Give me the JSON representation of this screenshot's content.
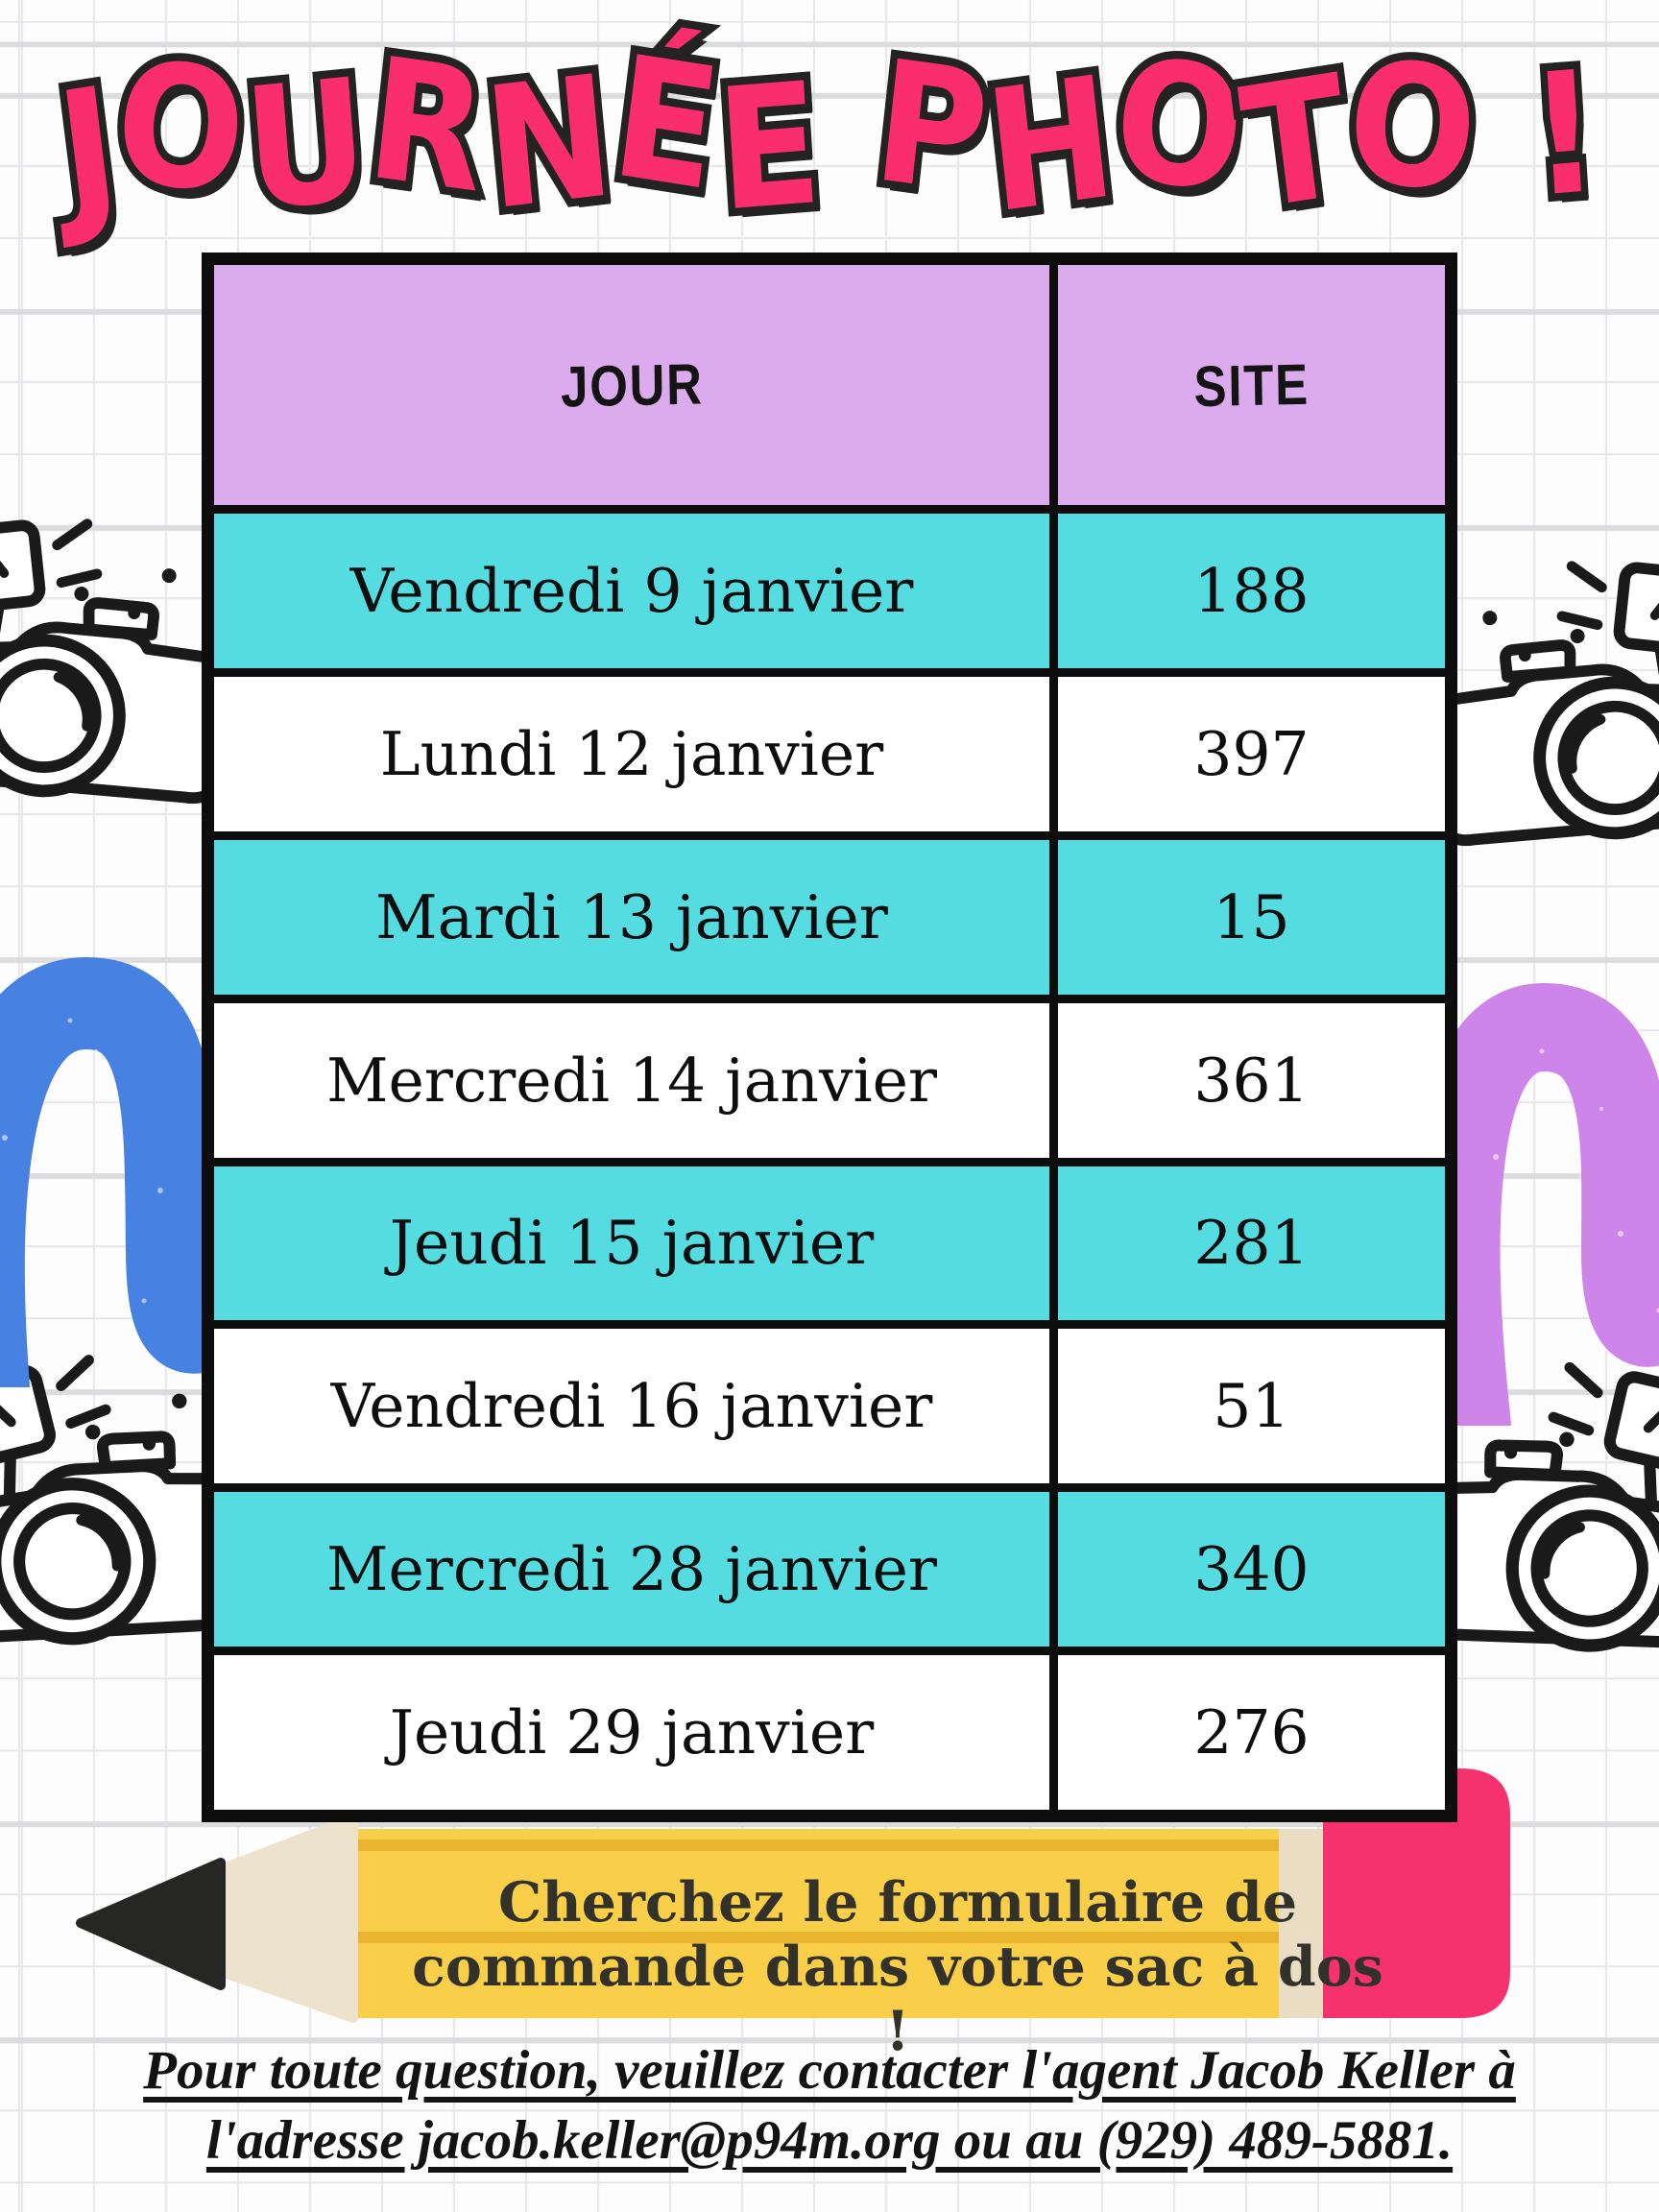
{
  "poster": {
    "title": "JOURNÉE PHOTO !",
    "table": {
      "headers": {
        "jour": "JOUR",
        "site": "SITE"
      },
      "rows": [
        {
          "jour": "Vendredi 9 janvier",
          "site": "188"
        },
        {
          "jour": "Lundi 12 janvier",
          "site": "397"
        },
        {
          "jour": "Mardi 13 janvier",
          "site": "15"
        },
        {
          "jour": "Mercredi 14 janvier",
          "site": "361"
        },
        {
          "jour": "Jeudi 15 janvier",
          "site": "281"
        },
        {
          "jour": "Vendredi 16 janvier",
          "site": "51"
        },
        {
          "jour": "Mercredi 28 janvier",
          "site": "340"
        },
        {
          "jour": "Jeudi 29 janvier",
          "site": "276"
        }
      ]
    },
    "pencil_note": {
      "line1": "Cherchez le formulaire de",
      "line2": "commande dans votre sac à dos !"
    },
    "footer": {
      "line1": "Pour toute question, veuillez contacter l'agent Jacob Keller à",
      "line2": "l'adresse jacob.keller@p94m.org ou au (929) 489-5881."
    },
    "colors": {
      "title_pink": "#fa2e6f",
      "outline_black": "#232323",
      "header_purple": "#dcabee",
      "row_cyan": "#55dce1",
      "pencil_yellow": "#f9ce49",
      "pencil_ridge": "#e9b52f",
      "pencil_wood": "#ede3cd",
      "eraser_pink": "#f5316e",
      "squiggle_blue": "#4781e1",
      "squiggle_purple": "#cd85e9"
    }
  }
}
